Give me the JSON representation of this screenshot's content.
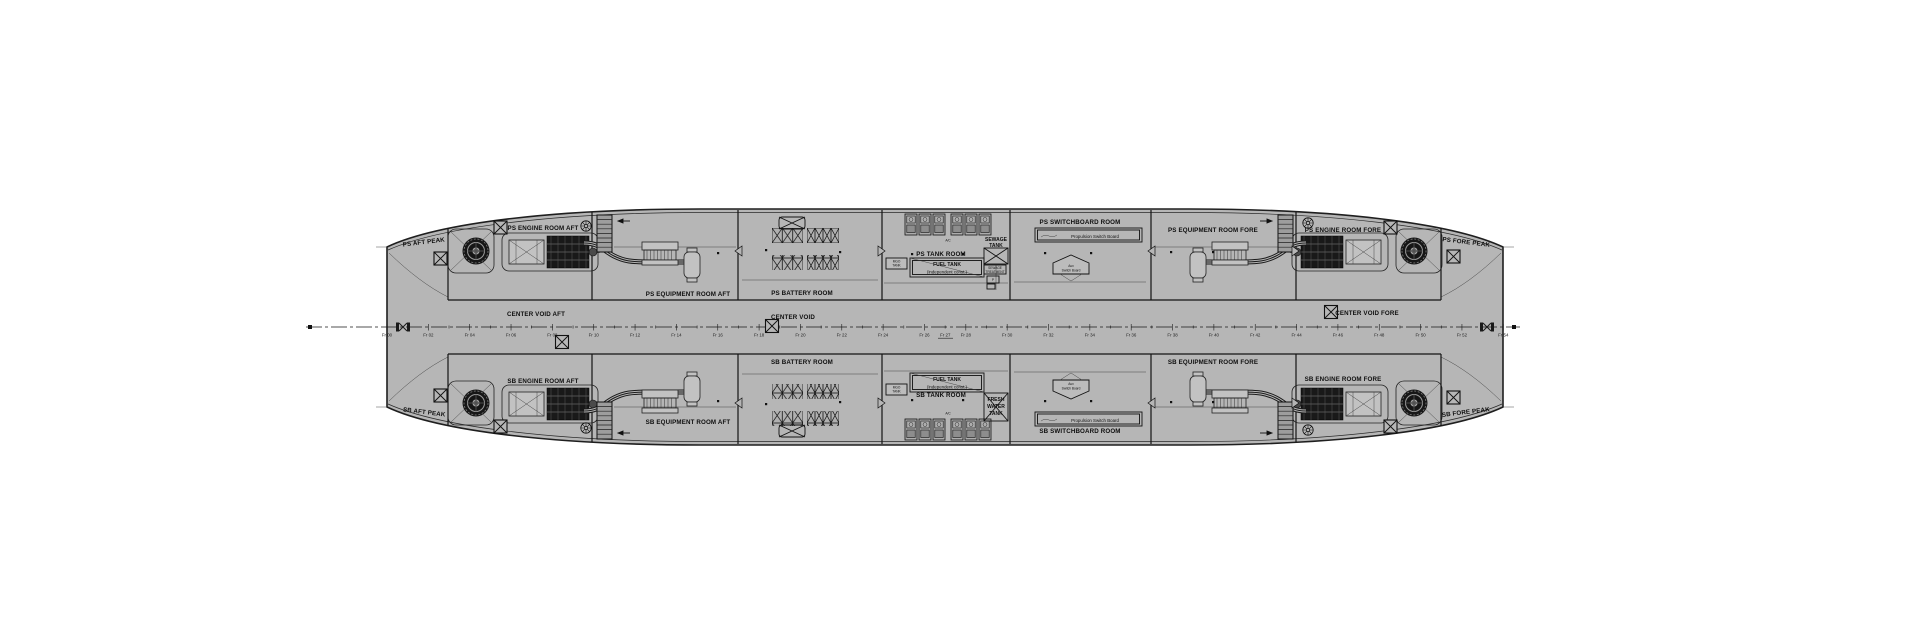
{
  "colors": {
    "background": "#ffffff",
    "hull_fill": "#b6b6b6",
    "line": "#1a1a1a",
    "equipment_dark": "#191919"
  },
  "rooms": {
    "ps": {
      "aft_peak": "PS AFT PEAK",
      "engine_aft": "PS ENGINE ROOM AFT",
      "equip_aft": "PS EQUIPMENT ROOM AFT",
      "battery": "PS BATTERY ROOM",
      "tank": "PS TANK ROOM",
      "switchboard": "PS SWITCHBOARD ROOM",
      "equip_fore": "PS EQUIPMENT ROOM FORE",
      "engine_fore": "PS ENGINE ROOM FORE",
      "fore_peak": "PS FORE PEAK"
    },
    "sb": {
      "aft_peak": "SB AFT PEAK",
      "engine_aft": "SB ENGINE ROOM AFT",
      "equip_aft": "SB EQUIPMENT ROOM AFT",
      "battery": "SB BATTERY ROOM",
      "tank": "SB TANK ROOM",
      "switchboard": "SB SWITCHBOARD ROOM",
      "equip_fore": "SB EQUIPMENT ROOM FORE",
      "engine_fore": "SB ENGINE ROOM FORE",
      "fore_peak": "SB FORE PEAK"
    },
    "center": {
      "void_aft": "CENTER VOID AFT",
      "void_mid": "CENTER VOID",
      "void_fore": "CENTER VOID FORE"
    }
  },
  "tanks": {
    "fuel_line1": "FUEL TANK",
    "fuel_line2": "(independent const.)",
    "sewage_line1": "SEWAGE",
    "sewage_line2": "TANK",
    "sewage_treatment_line1": "SEWAGE",
    "sewage_treatment_line2": "TREATMENT",
    "fresh_line1": "FRESH",
    "fresh_line2": "WATER",
    "fresh_line3": "TANK",
    "small_tank_line1": "MGO",
    "small_tank_line2": "TANK"
  },
  "equipment": {
    "ac": "A/C",
    "pump": "P"
  },
  "switchboards": {
    "propulsion": "Propulsion Switch Board",
    "aux_line1": "Aux",
    "aux_line2": "Switch Board"
  },
  "centerline": {
    "frames": [
      "Fr 00",
      "Fr 02",
      "Fr 04",
      "Fr 06",
      "Fr 08",
      "Fr 10",
      "Fr 12",
      "Fr 14",
      "Fr 16",
      "Fr 18",
      "Fr 20",
      "Fr 22",
      "Fr 24",
      "Fr 26",
      "Fr 28",
      "Fr 30",
      "Fr 32",
      "Fr 34",
      "Fr 36",
      "Fr 38",
      "Fr 40",
      "Fr 42",
      "Fr 44",
      "Fr 46",
      "Fr 48",
      "Fr 50",
      "Fr 52",
      "Fr 54"
    ],
    "midship_frame": "Fr 27"
  }
}
